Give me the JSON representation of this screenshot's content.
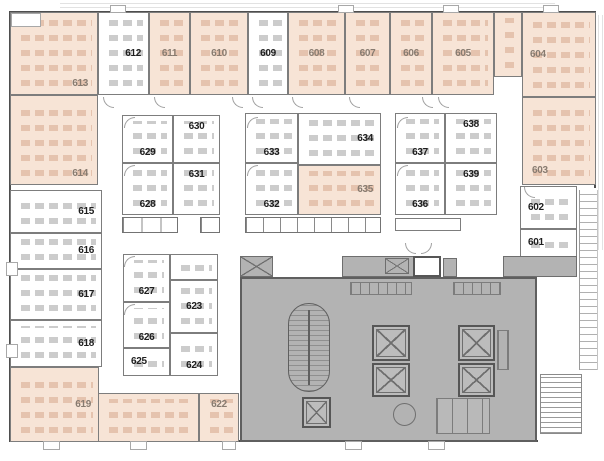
{
  "plan": {
    "width": 604,
    "height": 461,
    "colors": {
      "highlight_room": "#f7e4d6",
      "white_room": "#ffffff",
      "wall": "#7d7d7d",
      "outer_wall": "#4e4e4e",
      "core_fill": "#b3b3b3",
      "core_line": "#6e6e6e",
      "label_white_room": "#1e1e1e",
      "label_highlight_room": "#877b70",
      "desk_highlight": "#e5c3ae",
      "desk_white": "#cccccc"
    },
    "highlighted_rooms": [
      "603",
      "604",
      "605",
      "606",
      "607",
      "608",
      "610",
      "611",
      "613",
      "614",
      "619",
      "622",
      "635"
    ],
    "rooms": [
      {
        "num": "613",
        "x": 10,
        "y": 12,
        "w": 88,
        "h": 83,
        "hl": true,
        "lp": "br"
      },
      {
        "num": "612",
        "x": 98,
        "y": 12,
        "w": 51,
        "h": 83,
        "hl": false,
        "lp": "r"
      },
      {
        "num": "611",
        "x": 149,
        "y": 12,
        "w": 41,
        "h": 83,
        "hl": true,
        "lp": "c"
      },
      {
        "num": "610",
        "x": 190,
        "y": 12,
        "w": 58,
        "h": 83,
        "hl": true,
        "lp": "c"
      },
      {
        "num": "609",
        "x": 248,
        "y": 12,
        "w": 40,
        "h": 83,
        "hl": false,
        "lp": "c"
      },
      {
        "num": "608",
        "x": 288,
        "y": 12,
        "w": 57,
        "h": 83,
        "hl": true,
        "lp": "c"
      },
      {
        "num": "607",
        "x": 345,
        "y": 12,
        "w": 45,
        "h": 83,
        "hl": true,
        "lp": "c"
      },
      {
        "num": "606",
        "x": 390,
        "y": 12,
        "w": 42,
        "h": 83,
        "hl": true,
        "lp": "c"
      },
      {
        "num": "605",
        "x": 432,
        "y": 12,
        "w": 62,
        "h": 83,
        "hl": true,
        "lp": "c"
      },
      {
        "num": "",
        "x": 494,
        "y": 12,
        "w": 28,
        "h": 65,
        "hl": true,
        "lp": "c"
      },
      {
        "num": "604",
        "x": 522,
        "y": 12,
        "w": 74,
        "h": 85,
        "hl": true,
        "lp": "l"
      },
      {
        "num": "603",
        "x": 522,
        "y": 97,
        "w": 74,
        "h": 88,
        "hl": true,
        "lp": "bl"
      },
      {
        "num": "602",
        "x": 520,
        "y": 186,
        "w": 57,
        "h": 43,
        "hl": false,
        "lp": "l"
      },
      {
        "num": "601",
        "x": 520,
        "y": 229,
        "w": 57,
        "h": 28,
        "hl": false,
        "lp": "l"
      },
      {
        "num": "614",
        "x": 10,
        "y": 95,
        "w": 88,
        "h": 90,
        "hl": true,
        "lp": "br"
      },
      {
        "num": "615",
        "x": 10,
        "y": 190,
        "w": 92,
        "h": 43,
        "hl": false,
        "lp": "r"
      },
      {
        "num": "616",
        "x": 10,
        "y": 233,
        "w": 92,
        "h": 36,
        "hl": false,
        "lp": "r"
      },
      {
        "num": "617",
        "x": 10,
        "y": 269,
        "w": 92,
        "h": 51,
        "hl": false,
        "lp": "r"
      },
      {
        "num": "618",
        "x": 10,
        "y": 320,
        "w": 92,
        "h": 47,
        "hl": false,
        "lp": "r"
      },
      {
        "num": "619",
        "x": 10,
        "y": 367,
        "w": 89,
        "h": 75,
        "hl": true,
        "lp": "r"
      },
      {
        "num": "",
        "x": 98,
        "y": 393,
        "w": 101,
        "h": 49,
        "hl": true,
        "lp": "c"
      },
      {
        "num": "622",
        "x": 199,
        "y": 393,
        "w": 40,
        "h": 49,
        "hl": true,
        "lp": "t"
      },
      {
        "num": "629",
        "x": 122,
        "y": 115,
        "w": 51,
        "h": 48,
        "hl": false,
        "lp": "b"
      },
      {
        "num": "630",
        "x": 173,
        "y": 115,
        "w": 47,
        "h": 48,
        "hl": false,
        "lp": "t"
      },
      {
        "num": "628",
        "x": 122,
        "y": 163,
        "w": 51,
        "h": 52,
        "hl": false,
        "lp": "b"
      },
      {
        "num": "631",
        "x": 173,
        "y": 163,
        "w": 47,
        "h": 52,
        "hl": false,
        "lp": "t"
      },
      {
        "num": "633",
        "x": 245,
        "y": 113,
        "w": 53,
        "h": 50,
        "hl": false,
        "lp": "b"
      },
      {
        "num": "634",
        "x": 298,
        "y": 113,
        "w": 83,
        "h": 52,
        "hl": false,
        "lp": "r"
      },
      {
        "num": "632",
        "x": 245,
        "y": 163,
        "w": 53,
        "h": 52,
        "hl": false,
        "lp": "b"
      },
      {
        "num": "635",
        "x": 298,
        "y": 165,
        "w": 83,
        "h": 50,
        "hl": true,
        "lp": "r"
      },
      {
        "num": "637",
        "x": 395,
        "y": 113,
        "w": 50,
        "h": 50,
        "hl": false,
        "lp": "b"
      },
      {
        "num": "638",
        "x": 445,
        "y": 113,
        "w": 52,
        "h": 50,
        "hl": false,
        "lp": "t"
      },
      {
        "num": "636",
        "x": 395,
        "y": 163,
        "w": 50,
        "h": 52,
        "hl": false,
        "lp": "b"
      },
      {
        "num": "639",
        "x": 445,
        "y": 163,
        "w": 52,
        "h": 52,
        "hl": false,
        "lp": "t"
      },
      {
        "num": "627",
        "x": 123,
        "y": 254,
        "w": 47,
        "h": 48,
        "hl": false,
        "lp": "b"
      },
      {
        "num": "",
        "x": 170,
        "y": 254,
        "w": 48,
        "h": 26,
        "hl": false,
        "lp": "c"
      },
      {
        "num": "623",
        "x": 170,
        "y": 280,
        "w": 48,
        "h": 53,
        "hl": false,
        "lp": "c"
      },
      {
        "num": "626",
        "x": 123,
        "y": 302,
        "w": 47,
        "h": 46,
        "hl": false,
        "lp": "b"
      },
      {
        "num": "625",
        "x": 123,
        "y": 348,
        "w": 47,
        "h": 28,
        "hl": false,
        "lp": "l"
      },
      {
        "num": "624",
        "x": 170,
        "y": 333,
        "w": 48,
        "h": 43,
        "hl": false,
        "lp": "b"
      },
      {
        "num": "",
        "x": 395,
        "y": 218,
        "w": 66,
        "h": 13,
        "hl": false,
        "lp": "c"
      }
    ],
    "stall_rows": [
      {
        "x": 122,
        "y": 217,
        "w": 56,
        "h": 16,
        "n": 3
      },
      {
        "x": 200,
        "y": 217,
        "w": 20,
        "h": 16,
        "n": 1
      },
      {
        "x": 245,
        "y": 217,
        "w": 136,
        "h": 16,
        "n": 8
      }
    ],
    "core": {
      "main": {
        "x": 240,
        "y": 277,
        "w": 297,
        "h": 165
      },
      "strip_601": {
        "x": 503,
        "y": 256,
        "w": 74,
        "h": 21
      },
      "vent_boxes": [
        {
          "x": 240,
          "y": 256,
          "w": 33,
          "h": 21,
          "x_mark": true
        },
        {
          "x": 342,
          "y": 256,
          "w": 72,
          "h": 21,
          "x_mark": false
        },
        {
          "x": 385,
          "y": 258,
          "w": 24,
          "h": 16,
          "x_mark": true
        },
        {
          "x": 443,
          "y": 258,
          "w": 14,
          "h": 19,
          "x_mark": false
        }
      ],
      "white_cell": {
        "x": 413,
        "y": 256,
        "w": 28,
        "h": 21
      },
      "stair_oval": {
        "x": 288,
        "y": 303,
        "w": 42,
        "h": 89
      },
      "elevator_shafts": [
        {
          "x": 372,
          "y": 325,
          "w": 38,
          "h": 36
        },
        {
          "x": 372,
          "y": 363,
          "w": 38,
          "h": 34
        },
        {
          "x": 458,
          "y": 325,
          "w": 37,
          "h": 36
        },
        {
          "x": 458,
          "y": 363,
          "w": 37,
          "h": 34
        },
        {
          "x": 302,
          "y": 397,
          "w": 29,
          "h": 31
        }
      ],
      "shelves": [
        {
          "x": 350,
          "y": 282,
          "w": 62,
          "h": 13
        },
        {
          "x": 453,
          "y": 282,
          "w": 48,
          "h": 13
        },
        {
          "x": 497,
          "y": 330,
          "w": 12,
          "h": 40
        }
      ],
      "restroom": {
        "x": 436,
        "y": 398,
        "w": 54,
        "h": 36
      },
      "table": {
        "x": 393,
        "y": 403,
        "w": 23,
        "h": 23
      },
      "balcony": {
        "x": 579,
        "y": 190,
        "w": 19,
        "h": 180
      },
      "exterior_stair": {
        "x": 540,
        "y": 374,
        "w": 42,
        "h": 60
      }
    },
    "walls": [
      {
        "x": 10,
        "y": 11,
        "w": 586,
        "h": 2
      },
      {
        "x": 9,
        "y": 11,
        "w": 2,
        "h": 431
      },
      {
        "x": 9,
        "y": 440,
        "w": 529,
        "h": 2
      },
      {
        "x": 594,
        "y": 11,
        "w": 2,
        "h": 177
      }
    ],
    "columns": [
      {
        "x": 110,
        "y": 5,
        "w": 16,
        "h": 8
      },
      {
        "x": 338,
        "y": 5,
        "w": 16,
        "h": 8
      },
      {
        "x": 443,
        "y": 5,
        "w": 16,
        "h": 8
      },
      {
        "x": 543,
        "y": 5,
        "w": 16,
        "h": 8
      },
      {
        "x": 43,
        "y": 441,
        "w": 17,
        "h": 9
      },
      {
        "x": 130,
        "y": 441,
        "w": 17,
        "h": 9
      },
      {
        "x": 222,
        "y": 441,
        "w": 14,
        "h": 9
      },
      {
        "x": 345,
        "y": 441,
        "w": 17,
        "h": 9
      },
      {
        "x": 428,
        "y": 441,
        "w": 17,
        "h": 9
      },
      {
        "x": 6,
        "y": 262,
        "w": 12,
        "h": 14
      },
      {
        "x": 6,
        "y": 344,
        "w": 12,
        "h": 14
      },
      {
        "x": 11,
        "y": 13,
        "w": 30,
        "h": 14
      }
    ],
    "faint_lines": [
      {
        "x": 60,
        "y": 3,
        "w": 495,
        "h": 1
      },
      {
        "x": 60,
        "y": 7,
        "w": 495,
        "h": 1
      },
      {
        "x": 598,
        "y": 15,
        "w": 1,
        "h": 235
      },
      {
        "x": 602,
        "y": 15,
        "w": 1,
        "h": 235
      }
    ],
    "doors": [
      {
        "x": 103,
        "y": 97,
        "r": 0
      },
      {
        "x": 154,
        "y": 97,
        "r": 0
      },
      {
        "x": 232,
        "y": 97,
        "r": 0
      },
      {
        "x": 252,
        "y": 97,
        "r": 0
      },
      {
        "x": 292,
        "y": 97,
        "r": 0
      },
      {
        "x": 349,
        "y": 97,
        "r": 0
      },
      {
        "x": 422,
        "y": 97,
        "r": 0
      },
      {
        "x": 438,
        "y": 97,
        "r": 0
      },
      {
        "x": 524,
        "y": 187,
        "r": 0
      },
      {
        "x": 124,
        "y": 117,
        "r": 90
      },
      {
        "x": 124,
        "y": 165,
        "r": 90
      },
      {
        "x": 247,
        "y": 117,
        "r": 90
      },
      {
        "x": 247,
        "y": 165,
        "r": 90
      },
      {
        "x": 397,
        "y": 117,
        "r": 90
      },
      {
        "x": 397,
        "y": 165,
        "r": 90
      },
      {
        "x": 124,
        "y": 256,
        "r": 90
      },
      {
        "x": 124,
        "y": 304,
        "r": 90
      },
      {
        "x": 405,
        "y": 243,
        "r": 0
      },
      {
        "x": 421,
        "y": 243,
        "r": 270
      }
    ]
  }
}
